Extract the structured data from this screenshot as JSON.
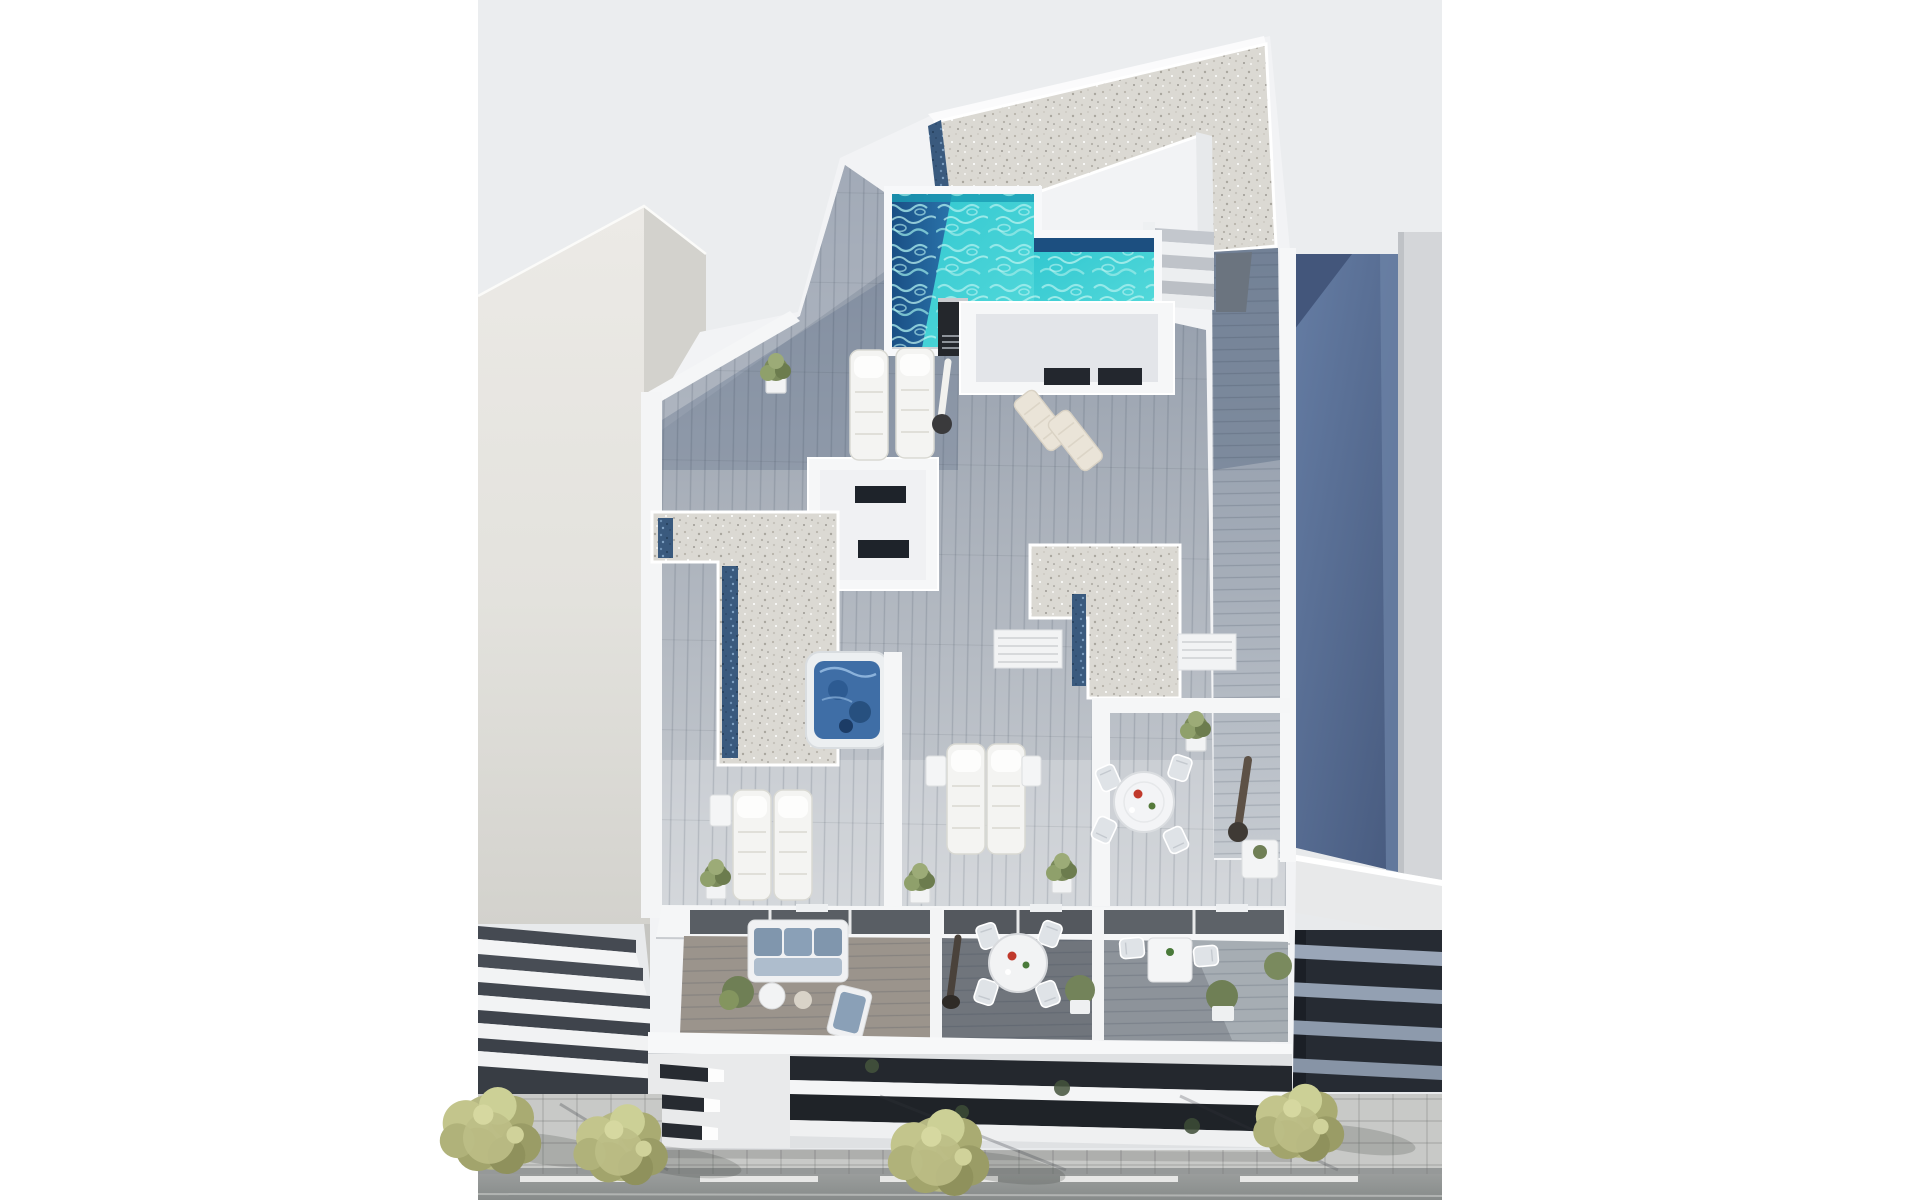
{
  "meta": {
    "title": "Aerial 3D render of modern apartment building",
    "description": "Aerial 3D architectural render of a white modern apartment building: rooftop terrace with L-shaped turquoise pool, gravel roofs, timber decks, jacuzzi, sun loungers and dining sets; three lower balconies with sofa and tables; neighbouring buildings and a street with four yellow-green trees"
  },
  "palette": {
    "page": "#ffffff",
    "backdrop": "#e8eaec",
    "white_building": "#f3f4f6",
    "beige_wall": "#e5e4df",
    "gravel": "#dbd9d3",
    "glass_strip": "#3a5a7e",
    "deck_shadow": "#8a95a5",
    "deck_light": "#c9cdd2",
    "pool_turquoise": "#3bced6",
    "pool_deep": "#1e5e96",
    "jacuzzi_water": "#3f6ea6",
    "neighbor_roof_blue": "#5a7198",
    "facade_dark": "#23272e",
    "sidewalk": "#c8c9c7",
    "street": "#939695",
    "tree_foliage": "#b5b782",
    "cushion_blue": "#8096ad"
  },
  "scene": {
    "background": {
      "label": "light gray studio backdrop"
    },
    "buildings": {
      "main": {
        "label": "main white apartment building with rooftop pool terrace"
      },
      "left": {
        "label": "left neighbouring building with stepped white balconies"
      },
      "right": {
        "label": "right neighbouring building with blue shaded roof and dark slab facade"
      }
    },
    "rooftop": {
      "gravel_roof": {
        "label": "gravel covered roof with dark glass skylight strips"
      },
      "pool": {
        "label": "L-shaped turquoise swimming pool with navy deep end",
        "water_color": "#3bced6",
        "deep_color": "#1e5e96"
      },
      "stairs": {
        "label": "roof access stairs"
      },
      "walkway": {
        "label": "side timber walkway"
      },
      "chimney": {
        "label": "black chimney vent with louvre"
      },
      "stair_bulkhead": {
        "label": "white stair bulkhead room with dark window slots"
      },
      "bedroom_cutaway": {
        "label": "white cut-away room with dark window slots"
      },
      "jacuzzi": {
        "label": "square jacuzzi hot tub with blue water"
      },
      "sun_loungers": {
        "label": "white sun loungers",
        "count": 8
      },
      "parasols": {
        "label": "closed parasols",
        "count": 3
      },
      "dining_set": {
        "label": "round white dining table with four chairs"
      },
      "planters": {
        "label": "potted green plants",
        "count": 9
      }
    },
    "lower_floor": {
      "balconies": {
        "label": "three lower-floor balconies divided by white partitions",
        "count": 3
      },
      "sofa": {
        "label": "balcony sofa with blue-gray cushions"
      },
      "dining_table": {
        "label": "round balcony dining table with four chairs"
      },
      "side_table": {
        "label": "small square balcony table with two chairs"
      },
      "facade": {
        "label": "white slab facade with dark recessed balcony strips"
      }
    },
    "street": {
      "sidewalk": {
        "label": "paved sidewalk with cast shadows"
      },
      "road": {
        "label": "asphalt road with dashed white line"
      },
      "trees": {
        "label": "yellow-green street trees",
        "count": 4
      }
    }
  }
}
